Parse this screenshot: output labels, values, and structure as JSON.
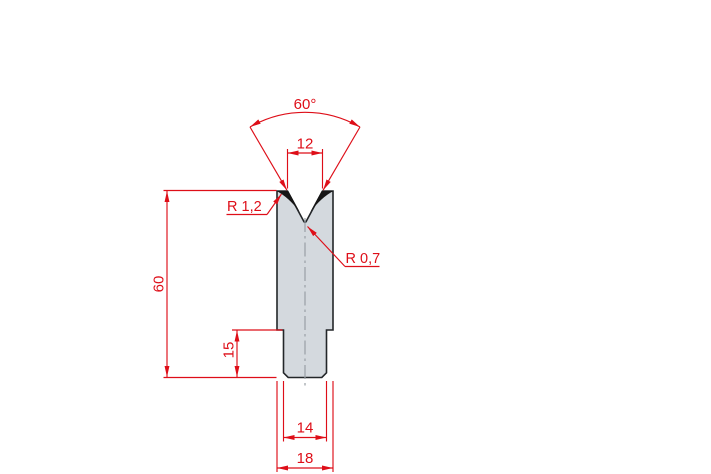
{
  "drawing": {
    "type": "technical-drawing",
    "subject": "V-die cross-section (press brake lower tool)",
    "labels": {
      "angle": "60°",
      "vee_width": "12",
      "radius_shoulder": "R 1,2",
      "radius_groove": "R 0,7",
      "height_total": "60",
      "height_shank": "15",
      "width_shank": "14",
      "width_body": "18"
    },
    "colors": {
      "dimension_red": "#de0e18",
      "body_fill": "#d4d9de",
      "body_outline": "#232629",
      "shoulder_fill": "#151515",
      "centerline_gray": "#9aa0a5",
      "background": "#ffffff"
    }
  }
}
